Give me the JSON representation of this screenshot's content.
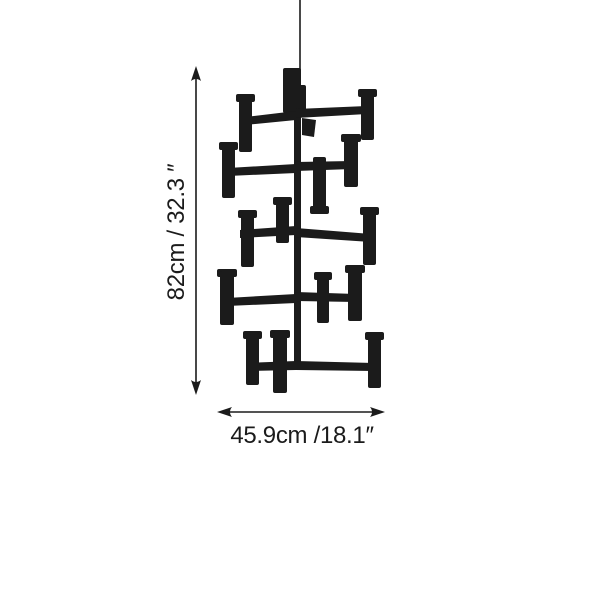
{
  "colors": {
    "ink": "#1b1b1b",
    "background": "#ffffff"
  },
  "figure": {
    "name": "five-tier-chandelier-silhouette"
  },
  "dimensions": {
    "height": {
      "label": "82cm / 32.3 ″"
    },
    "width": {
      "label": "45.9cm /18.1″"
    }
  }
}
